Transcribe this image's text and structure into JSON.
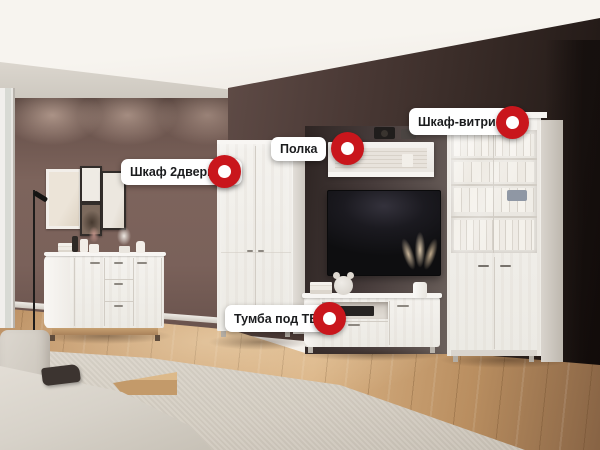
{
  "theme": {
    "marker_color": "#c9161c",
    "marker_center_color": "#ffffff",
    "label_bg": "#ffffff",
    "label_text_color": "#1b1c1e"
  },
  "hotspots": [
    {
      "id": "wardrobe",
      "label": "Шкаф 2дверный"
    },
    {
      "id": "shelf",
      "label": "Полка"
    },
    {
      "id": "display-cabinet",
      "label": "Шкаф-витрина"
    },
    {
      "id": "tv-stand",
      "label": "Тумба под ТВ"
    }
  ]
}
